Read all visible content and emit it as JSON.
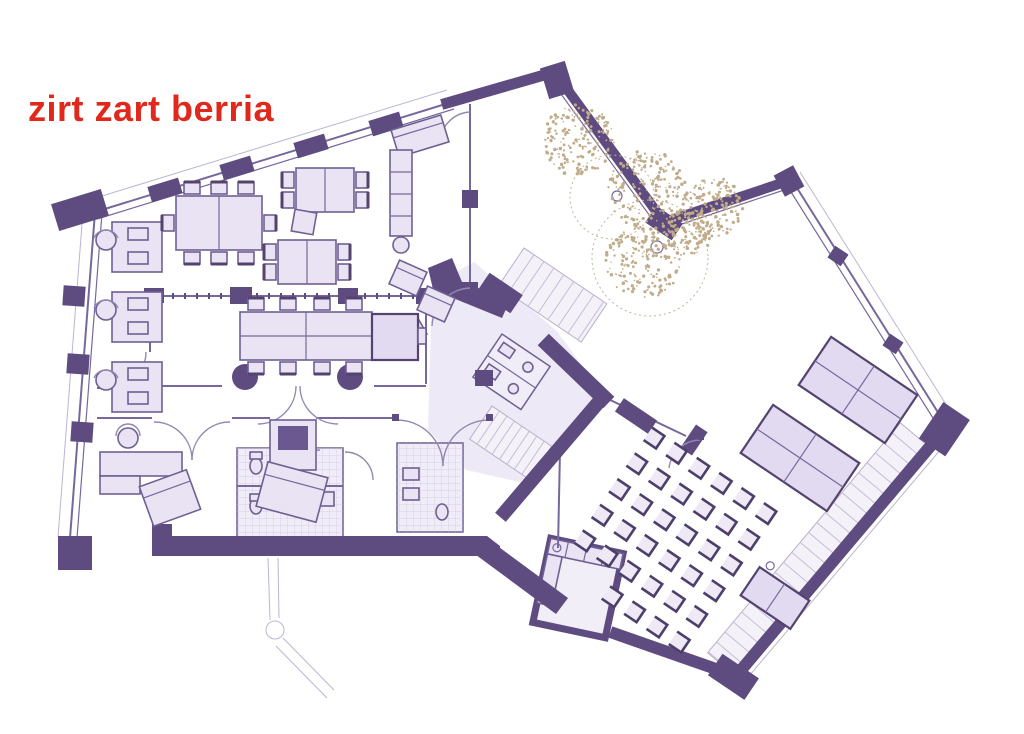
{
  "title": {
    "text": "zirt zart berria"
  },
  "palette": {
    "accent_red": "#e0281c",
    "wall_purple": "#5e4b80",
    "line_purple": "#77689c",
    "furniture_fill": "#eae3f4",
    "floor_tint": "#eee9f7",
    "tree_tan": "#c0ab8a",
    "background": "#ffffff"
  },
  "floorplan": {
    "type": "architectural-floor-plan",
    "classroom": {
      "rows": 6,
      "cols": 6,
      "skip": [
        [
          5,
          0
        ],
        [
          5,
          1
        ]
      ]
    },
    "left_workstations": 3,
    "meeting_room_seats": 8,
    "hall_table_groups": 2,
    "trees": 5
  }
}
